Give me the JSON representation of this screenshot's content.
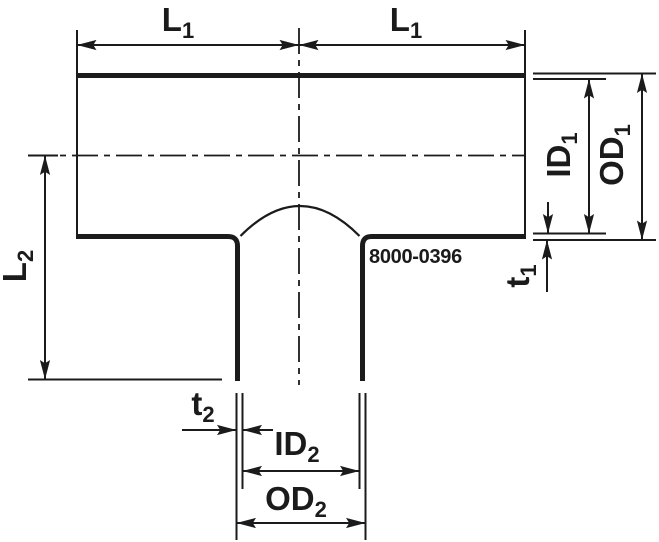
{
  "drawing": {
    "part_number": "8000-0396",
    "labels": {
      "l1_left": {
        "base": "L",
        "sub": "1"
      },
      "l1_right": {
        "base": "L",
        "sub": "1"
      },
      "id1": {
        "base": "ID",
        "sub": "1"
      },
      "od1": {
        "base": "OD",
        "sub": "1"
      },
      "t1": {
        "base": "t",
        "sub": "1"
      },
      "l2": {
        "base": "L",
        "sub": "2"
      },
      "t2": {
        "base": "t",
        "sub": "2"
      },
      "id2": {
        "base": "ID",
        "sub": "2"
      },
      "od2": {
        "base": "OD",
        "sub": "2"
      }
    },
    "colors": {
      "line": "#1b1b1b",
      "background": "#ffffff"
    }
  }
}
